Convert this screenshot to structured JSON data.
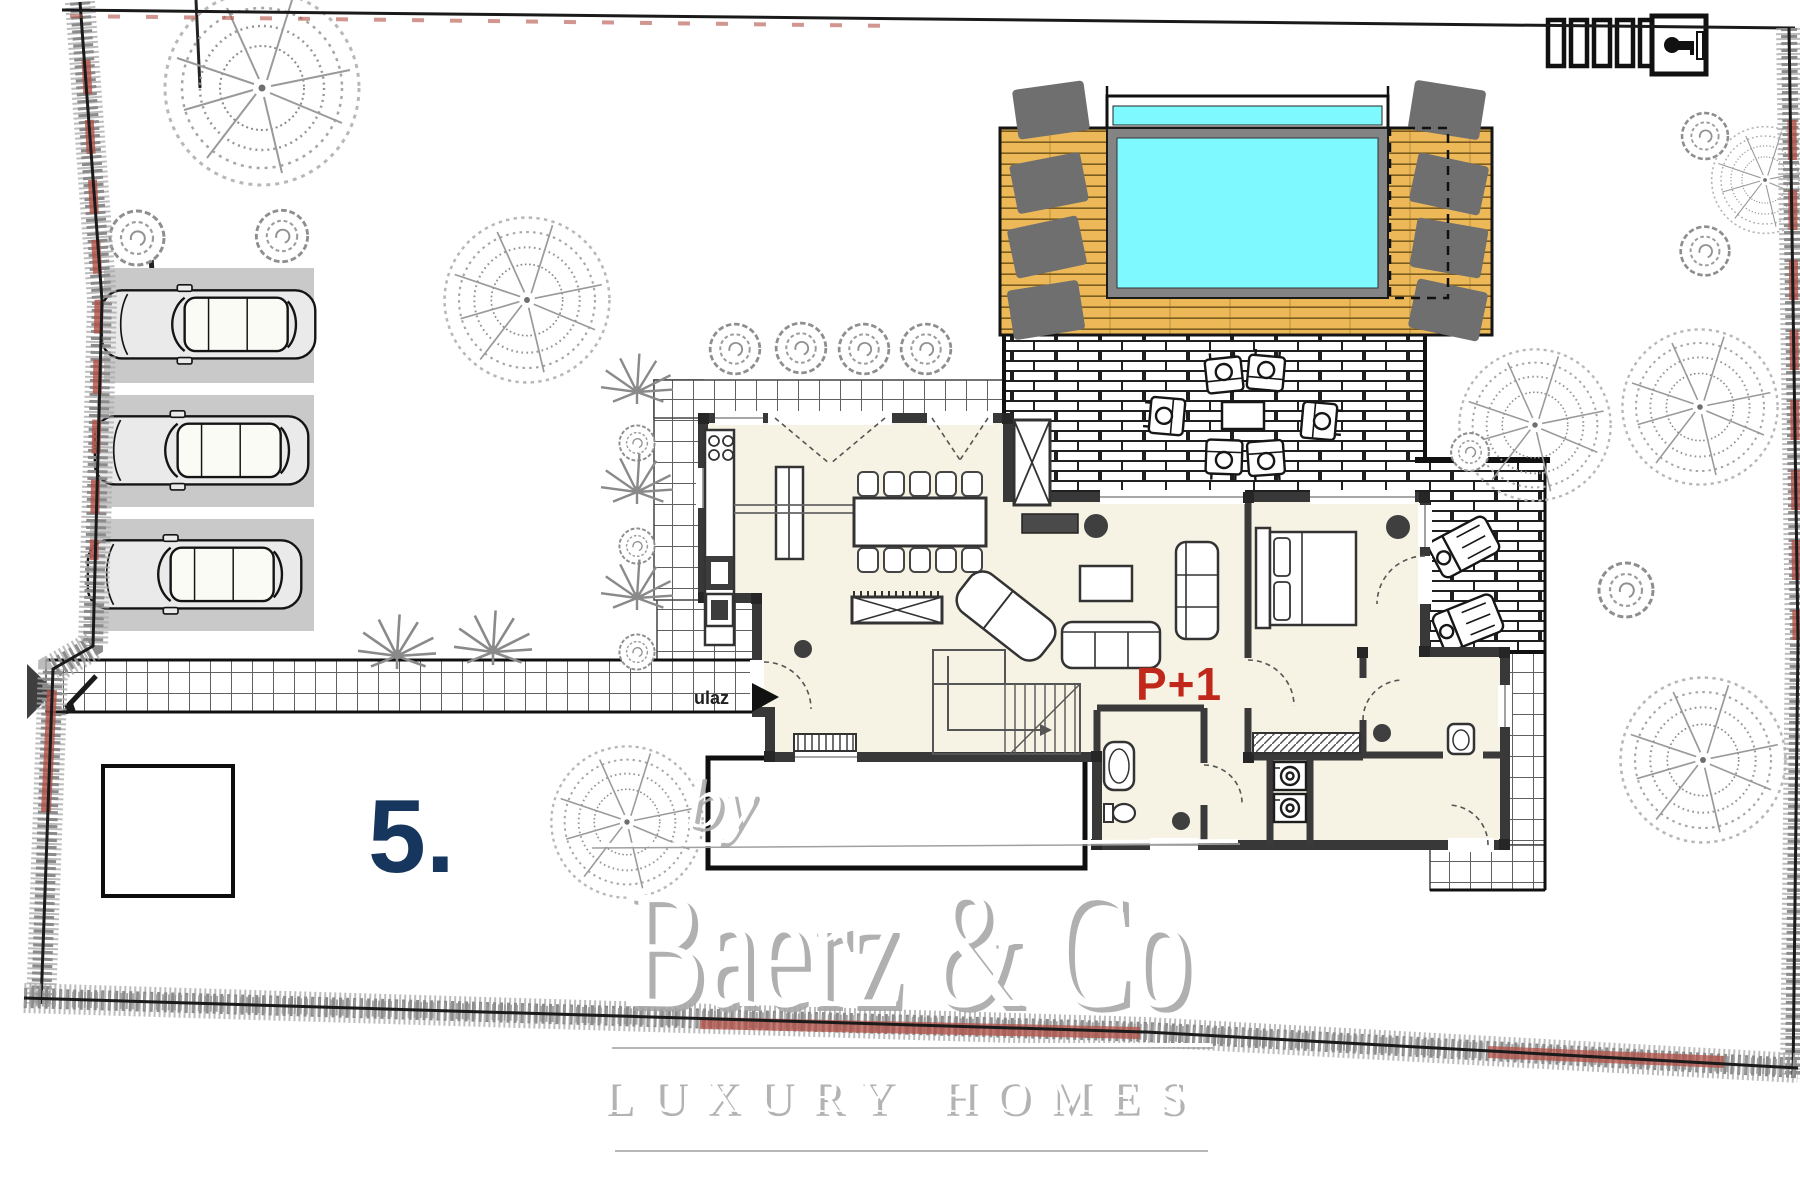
{
  "plan": {
    "entrance_label": "ulaz",
    "floor_label": "P+1",
    "plot_number": "5.",
    "parking_spaces": 3,
    "icons": [
      "trash-bins-icon",
      "gate-key-icon"
    ]
  },
  "watermark": {
    "prefix": "by",
    "brand": "Baerz & Co",
    "tagline": "LUXURY HOMES"
  },
  "colors": {
    "pool_water": "#7EF9FF",
    "pool_frame": "#848484",
    "deck_wood": "#EDB958",
    "sun_lounger": "#6F6F6F",
    "parking_stall": "#C9C9C9",
    "floor_cream": "#F6F3E4",
    "wall_dark": "#3A3A3A",
    "floor_label_red": "#C0281C",
    "plot_number_navy": "#16365D",
    "hedge_accent_red": "#B25046",
    "vegetation_gray": "#9A9A9A"
  }
}
